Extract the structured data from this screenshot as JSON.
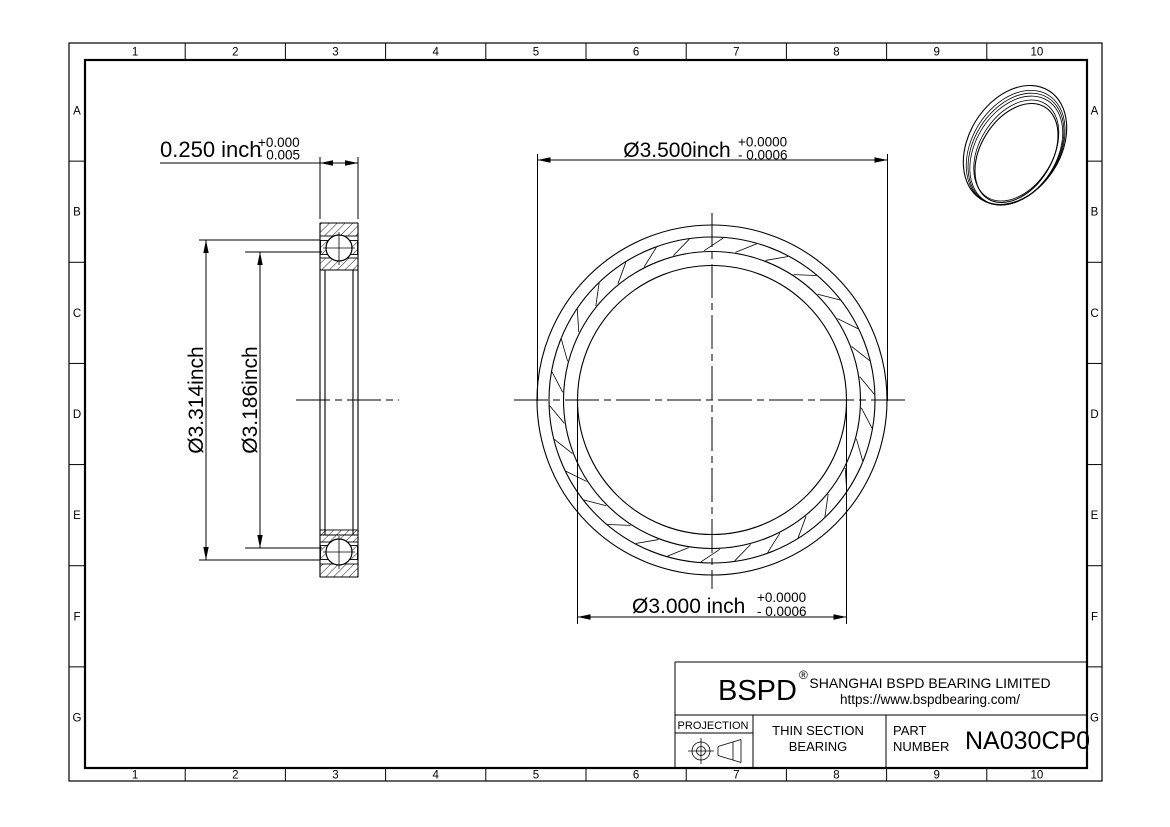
{
  "frame": {
    "columns": [
      "1",
      "2",
      "3",
      "4",
      "5",
      "6",
      "7",
      "8",
      "9",
      "10"
    ],
    "rows": [
      "A",
      "B",
      "C",
      "D",
      "E",
      "F",
      "G"
    ]
  },
  "dimensions": {
    "width": {
      "value": "0.250 inch",
      "tol_plus": "+0.000",
      "tol_minus": "- 0.005"
    },
    "outer_race": {
      "value": "Ø3.314inch"
    },
    "inner_race": {
      "value": "Ø3.186inch"
    },
    "outer_diameter": {
      "value": "Ø3.500inch",
      "tol_plus": "+0.0000",
      "tol_minus": "- 0.0006"
    },
    "bore_diameter": {
      "value": "Ø3.000 inch",
      "tol_plus": "+0.0000",
      "tol_minus": "- 0.0006"
    }
  },
  "title_block": {
    "brand": "BSPD",
    "brand_reg": "®",
    "company": "SHANGHAI BSPD BEARING LIMITED",
    "website": "https://www.bspdbearing.com/",
    "projection_label": "PROJECTION",
    "product_line1": "THIN SECTION",
    "product_line2": "BEARING",
    "part_label_line1": "PART",
    "part_label_line2": "NUMBER",
    "part_number": "NA030CP0"
  },
  "colors": {
    "line": "#000000",
    "background": "#ffffff"
  }
}
